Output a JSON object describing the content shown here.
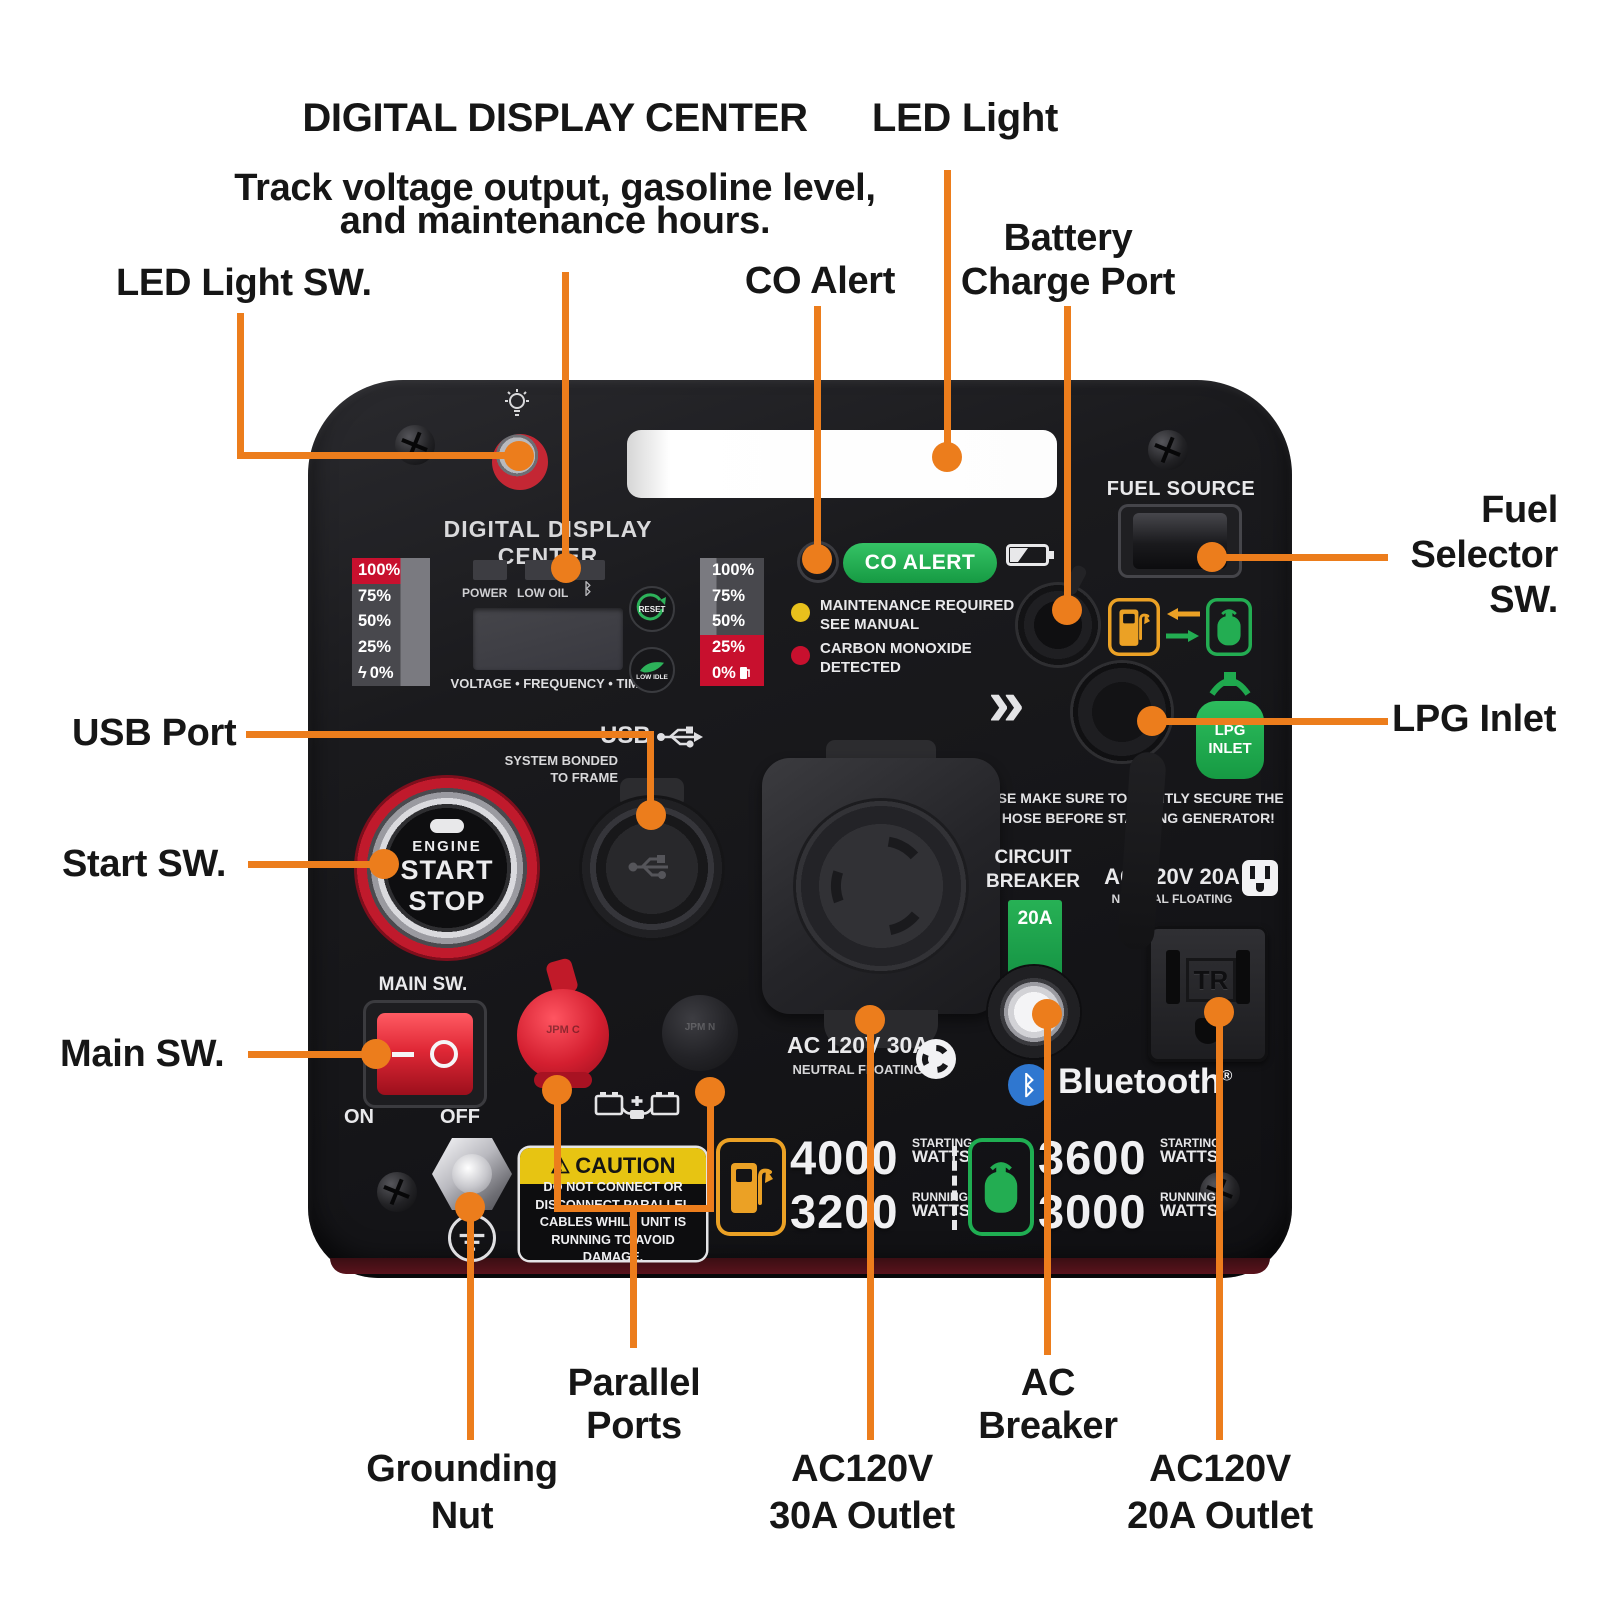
{
  "colors": {
    "accent": "#EC7D1C",
    "panel_black": "#17171A",
    "alert_red": "#C8102E",
    "green": "#1FA94E",
    "caution_yellow": "#E7C412",
    "bluetooth_blue": "#2F77D0"
  },
  "callouts": {
    "digital_display": {
      "title": "DIGITAL DISPLAY CENTER",
      "subtitle1": "Track voltage output, gasoline level,",
      "subtitle2": "and maintenance hours."
    },
    "led_light": {
      "label": "LED Light"
    },
    "led_light_sw": {
      "label": "LED Light SW."
    },
    "co_alert": {
      "label": "CO Alert"
    },
    "battery_charge_port": {
      "line1": "Battery",
      "line2": "Charge Port"
    },
    "fuel_selector_sw": {
      "line1": "Fuel",
      "line2": "Selector",
      "line3": "SW."
    },
    "lpg_inlet": {
      "label": "LPG Inlet"
    },
    "usb_port": {
      "label": "USB Port"
    },
    "start_sw": {
      "label": "Start SW."
    },
    "main_sw": {
      "label": "Main SW."
    },
    "grounding_nut": {
      "line1": "Grounding",
      "line2": "Nut"
    },
    "parallel_ports": {
      "line1": "Parallel",
      "line2": "Ports"
    },
    "ac120v_30a": {
      "line1": "AC120V",
      "line2": "30A Outlet"
    },
    "ac_breaker": {
      "line1": "AC",
      "line2": "Breaker"
    },
    "ac120v_20a": {
      "line1": "AC120V",
      "line2": "20A Outlet"
    }
  },
  "panel": {
    "display_title": "DIGITAL DISPLAY CENTER",
    "fuel_source_label": "FUEL SOURCE",
    "gauge_left": {
      "rows": [
        "100%",
        "75%",
        "50%",
        "25%",
        "0%"
      ]
    },
    "gauge_right": {
      "rows": [
        "100%",
        "75%",
        "50%",
        "25%",
        "0%"
      ]
    },
    "bolt_glyph": "ϟ",
    "power_label": "POWER",
    "low_oil_label": "LOW OIL",
    "bluetooth_glyph": "ᛒ",
    "reset_label": "RESET",
    "low_idle_label": "LOW IDLE",
    "screen_caption": "VOLTAGE • FREQUENCY • TIME",
    "co_alert_badge": "CO ALERT",
    "maintenance_line1": "MAINTENANCE REQUIRED",
    "maintenance_line2": "SEE MANUAL",
    "co_detected_line1": "CARBON MONOXIDE",
    "co_detected_line2": "DETECTED",
    "usb_label": "USB",
    "usb_note1": "SYSTEM BONDED",
    "usb_note2": "TO FRAME",
    "start_button": {
      "line1": "ENGINE",
      "line2": "START",
      "line3": "STOP"
    },
    "main_sw_label": "MAIN SW.",
    "on_label": "ON",
    "off_label": "OFF",
    "red_cap_label": "JPM C",
    "black_cap_label": "JPM N",
    "caution": {
      "warn_glyph": "⚠",
      "title": "CAUTION",
      "line1": "DO NOT CONNECT OR",
      "line2": "DISCONNECT PARALLEL",
      "line3": "CABLES WHILE UNIT IS",
      "line4": "RUNNING TO AVOID DAMAGE."
    },
    "chevrons": "»",
    "lpg_badge_line1": "LPG",
    "lpg_badge_line2": "INLET",
    "lpg_warning_line1": "PLEASE MAKE SURE TO TIGHTLY SECURE THE",
    "lpg_warning_line2": "LPG HOSE BEFORE STARTING GENERATOR!",
    "ac30_label": "AC 120V 30A",
    "ac30_sub": "NEUTRAL FLOATING",
    "circuit_breaker_line1": "CIRCUIT",
    "circuit_breaker_line2": "BREAKER",
    "breaker_rating": "20A",
    "ac20_label": "AC 120V 20A",
    "ac20_sub": "NEUTRAL FLOATING",
    "outlet_tr": "TR",
    "bluetooth_label": "Bluetooth",
    "bluetooth_reg": "®",
    "specs": {
      "gas": {
        "starting_value": "4000",
        "starting_line1": "STARTING",
        "starting_line2": "WATTS",
        "running_value": "3200",
        "running_line1": "RUNNING",
        "running_line2": "WATTS"
      },
      "lpg": {
        "starting_value": "3600",
        "starting_line1": "STARTING",
        "starting_line2": "WATTS",
        "running_value": "3000",
        "running_line1": "RUNNING",
        "running_line2": "WATTS"
      }
    }
  }
}
